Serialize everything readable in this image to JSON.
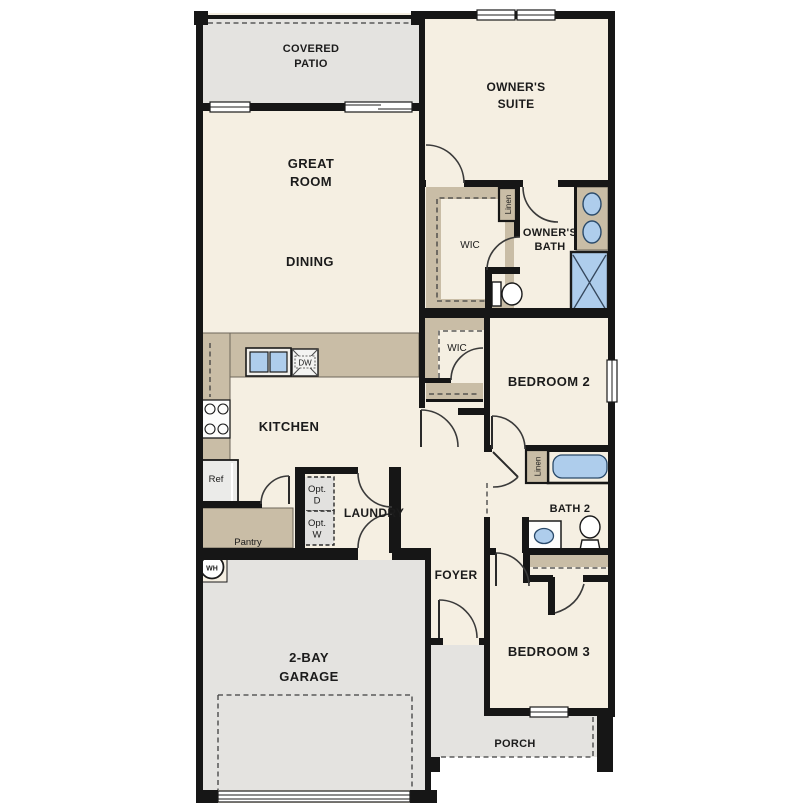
{
  "title": "Single-story home floor plan",
  "colors": {
    "floor_cream": "#f5efe2",
    "exterior_gray": "#e4e3e0",
    "cabinet_tan": "#c9bda6",
    "fixture_blue": "#aecdec",
    "wall_black": "#161616",
    "optional_gray": "#e2e1df"
  },
  "labels": {
    "covered_patio_1": "COVERED",
    "covered_patio_2": "PATIO",
    "great_room_1": "GREAT",
    "great_room_2": "ROOM",
    "dining": "DINING",
    "owners_suite_1": "OWNER'S",
    "owners_suite_2": "SUITE",
    "owners_bath_1": "OWNER'S",
    "owners_bath_2": "BATH",
    "wic_owner": "WIC",
    "wic_hall": "WIC",
    "linen_owner": "Linen",
    "linen_hall": "Linen",
    "bedroom_2": "BEDROOM 2",
    "bath_2": "BATH 2",
    "bedroom_3": "BEDROOM 3",
    "kitchen": "KITCHEN",
    "laundry": "LAUNDRY",
    "pantry": "Pantry",
    "foyer": "FOYER",
    "garage_1": "2-BAY",
    "garage_2": "GARAGE",
    "porch": "PORCH",
    "ref": "Ref",
    "dw": "DW",
    "wh": "WH",
    "opt_d_1": "Opt.",
    "opt_d_2": "D",
    "opt_w_1": "Opt.",
    "opt_w_2": "W"
  }
}
